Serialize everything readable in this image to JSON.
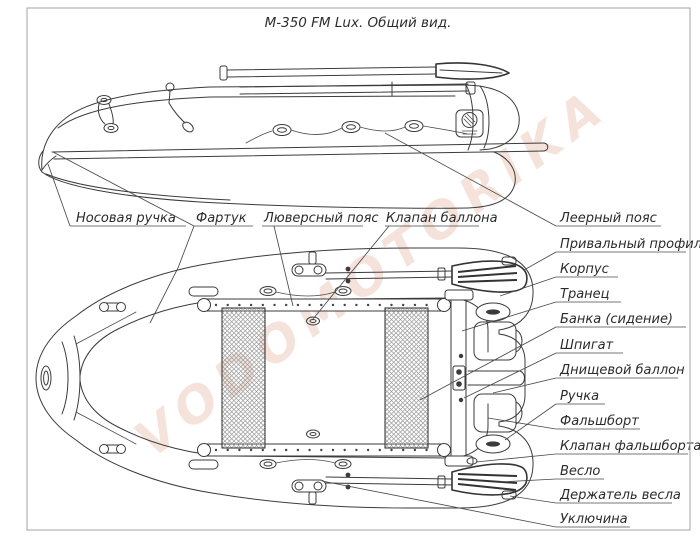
{
  "title": "М-350 FM Lux. Общий вид.",
  "watermark": "VODOMOTORIKA",
  "colors": {
    "line": "#3b3b3b",
    "frame_border": "#a3a3a3",
    "watermark": "#ecc9b8",
    "background": "#ffffff",
    "seat_mesh": "#9a9a9a"
  },
  "views": {
    "side": "боковой вид лодки",
    "top": "вид сверху"
  },
  "callouts": {
    "left": [
      {
        "id": "bow-handle",
        "text": "Носовая ручка"
      },
      {
        "id": "apron",
        "text": "Фартук"
      },
      {
        "id": "grommet-belt",
        "text": "Люверсный пояс"
      },
      {
        "id": "tube-valve",
        "text": "Клапан баллона"
      }
    ],
    "right": [
      {
        "id": "rail-rope",
        "text": "Леерный пояс"
      },
      {
        "id": "rub-profile",
        "text": "Привальный профиль"
      },
      {
        "id": "hull",
        "text": "Корпус"
      },
      {
        "id": "transom",
        "text": "Транец"
      },
      {
        "id": "seat",
        "text": "Банка (сидение)"
      },
      {
        "id": "scupper",
        "text": "Шпигат"
      },
      {
        "id": "bottom-tube",
        "text": "Днищевой баллон"
      },
      {
        "id": "handle",
        "text": "Ручка"
      },
      {
        "id": "bulwark",
        "text": "Фальшборт"
      },
      {
        "id": "bulwark-valve",
        "text": "Клапан фальшборта"
      },
      {
        "id": "oar",
        "text": "Весло"
      },
      {
        "id": "oar-holder",
        "text": "Держатель весла"
      },
      {
        "id": "oarlock",
        "text": "Уключина"
      }
    ]
  }
}
